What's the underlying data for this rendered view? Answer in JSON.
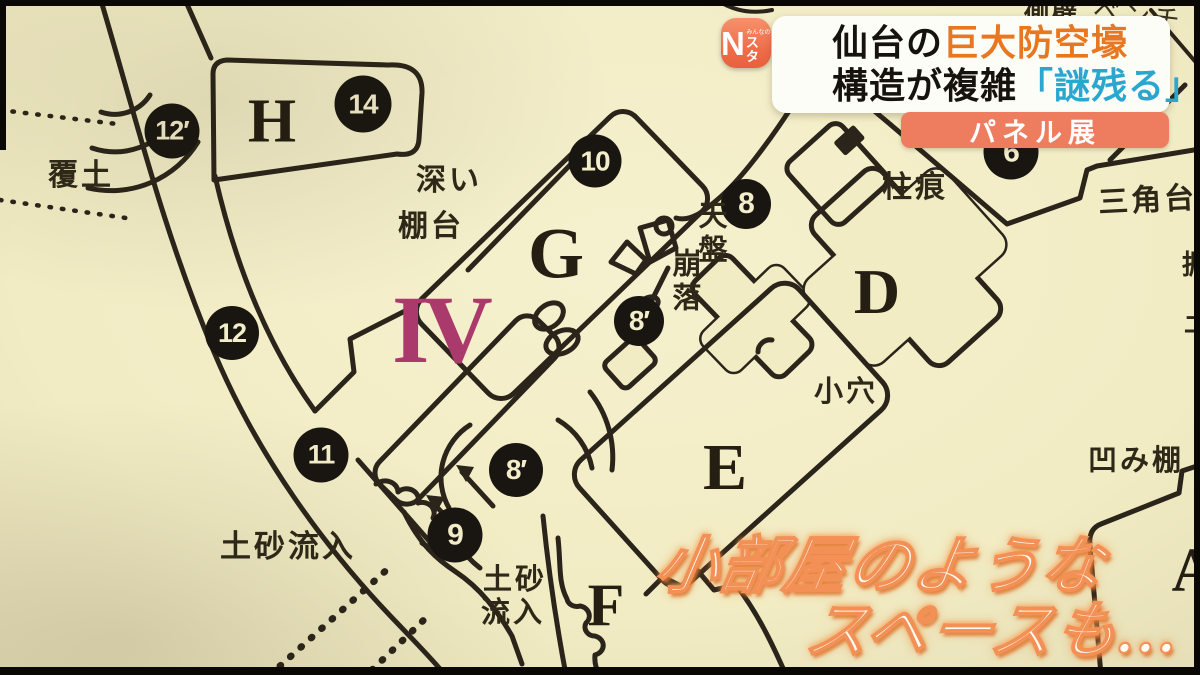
{
  "broadcast": {
    "logo": {
      "n": "N",
      "sub_top": "みんなの",
      "sub": "スタ"
    },
    "headline": {
      "line1_black": "仙台の",
      "line1_orange": "巨大防空壕",
      "line2_black": "構造が複雑",
      "line2_blue": "「謎残る」"
    },
    "badge": "パネル展",
    "caption": {
      "line1": "小部屋のような",
      "line2": "スペースも…"
    }
  },
  "map": {
    "section_numeral": "IV",
    "circles": [
      {
        "label": "12′"
      },
      {
        "label": "14"
      },
      {
        "label": "10"
      },
      {
        "label": "8"
      },
      {
        "label": "8′"
      },
      {
        "label": "12"
      },
      {
        "label": "11"
      },
      {
        "label": "8′"
      },
      {
        "label": "9"
      },
      {
        "label": "6"
      }
    ],
    "rooms": [
      {
        "label": "H"
      },
      {
        "label": "G"
      },
      {
        "label": "D"
      },
      {
        "label": "E"
      },
      {
        "label": "F"
      },
      {
        "label": "A"
      }
    ],
    "labels": [
      {
        "text": "覆土"
      },
      {
        "text": "深い"
      },
      {
        "text": "棚台"
      },
      {
        "text": "天盤"
      },
      {
        "text": "崩落"
      },
      {
        "text": "柱痕"
      },
      {
        "text": "三角台"
      },
      {
        "text": "小穴"
      },
      {
        "text": "凹み棚"
      },
      {
        "text": "土砂流入"
      },
      {
        "text": "土砂"
      },
      {
        "text": "流入"
      },
      {
        "text": "側壁"
      },
      {
        "text": "ベンチ"
      },
      {
        "text": "掘"
      },
      {
        "text": "土"
      }
    ]
  },
  "colors": {
    "paper_cream": "#f2ecc4",
    "line_ink": "#2a241a",
    "marker_black": "#191510",
    "headline_orange": "#e87722",
    "headline_blue": "#2ba6cf",
    "badge_orange": "#ee7d5f",
    "numeral_magenta": "#ab3a6c",
    "caption_glow": "#f29055"
  }
}
